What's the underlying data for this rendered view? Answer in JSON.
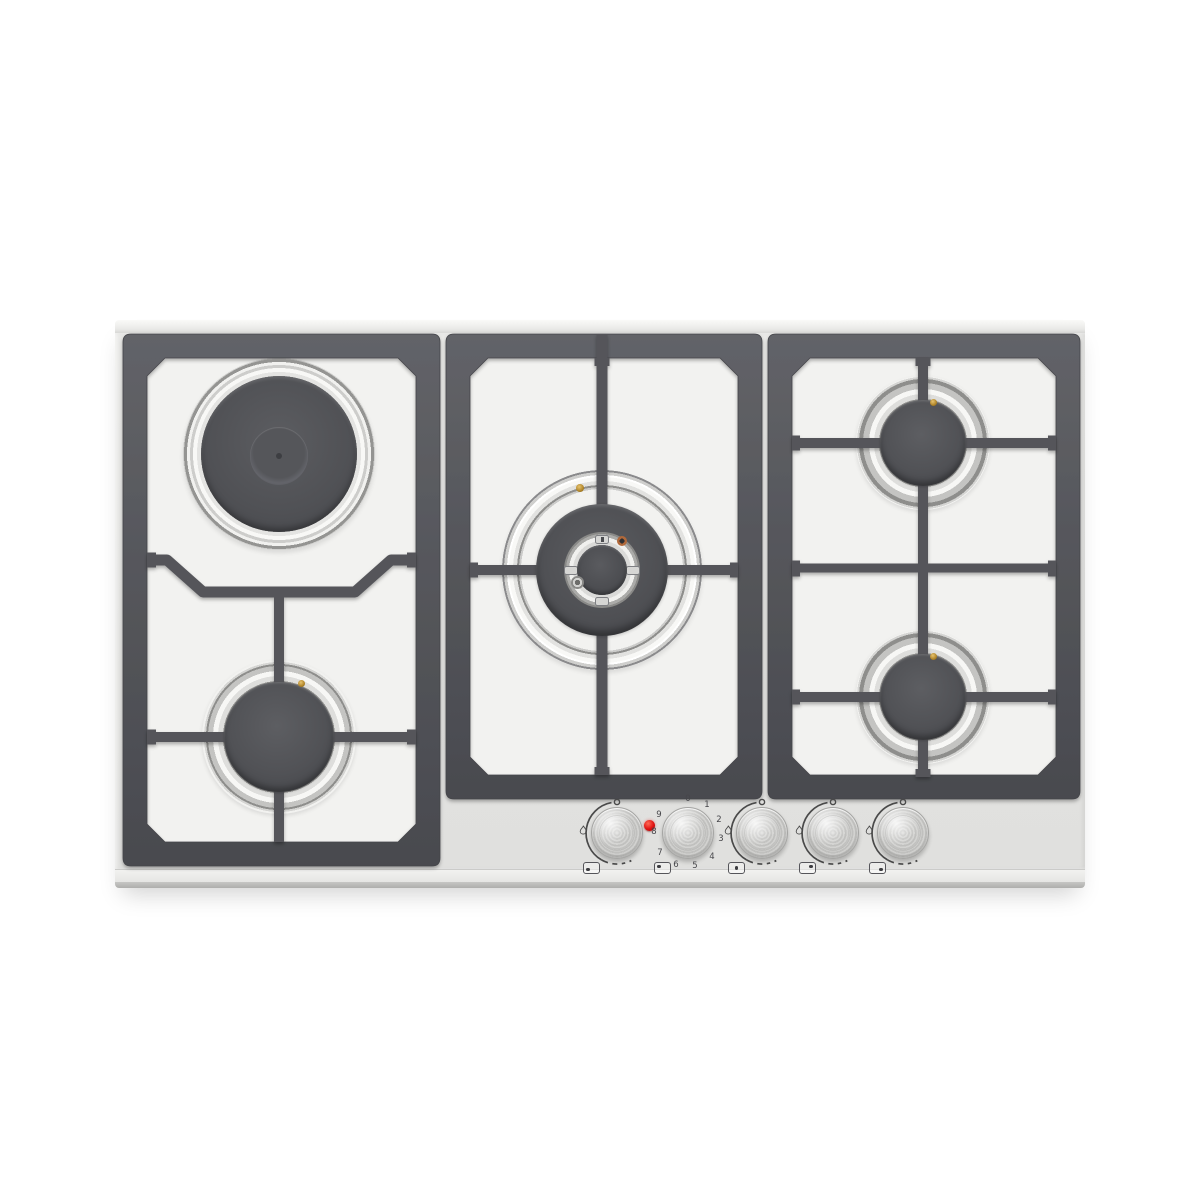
{
  "appliance": {
    "colors": {
      "surface_steel": "#e6e6e4",
      "window_steel": "#f2f2f0",
      "pan_support_grid": "#55565a",
      "burner_cap": "#515256",
      "stainless_ring": "#f7f7f5",
      "marking_print": "#4a4a4c",
      "pilot_light_red": "#e01212",
      "igniter_copper": "#b0683a",
      "thermocouple_brass": "#c09a40"
    },
    "burners": [
      {
        "id": "back-left",
        "kind": "electric-plate"
      },
      {
        "id": "front-left",
        "kind": "gas-burner"
      },
      {
        "id": "center",
        "kind": "wok-gas-burner"
      },
      {
        "id": "back-right",
        "kind": "gas-burner"
      },
      {
        "id": "front-right",
        "kind": "gas-burner"
      }
    ],
    "control_panel": {
      "knobs": [
        {
          "id": "front-left-gas",
          "type": "gas",
          "position_icon_dot": "bottom-left"
        },
        {
          "id": "back-left-electric",
          "type": "electric",
          "position_icon_dot": "top-left",
          "pilot_light_on": true,
          "scale": [
            "0",
            "1",
            "2",
            "3",
            "4",
            "5",
            "6",
            "7",
            "8",
            "9"
          ]
        },
        {
          "id": "center-wok-gas",
          "type": "gas",
          "position_icon_dot": "center"
        },
        {
          "id": "back-right-gas",
          "type": "gas",
          "position_icon_dot": "top-right"
        },
        {
          "id": "front-right-gas",
          "type": "gas",
          "position_icon_dot": "bottom-right"
        }
      ]
    }
  }
}
